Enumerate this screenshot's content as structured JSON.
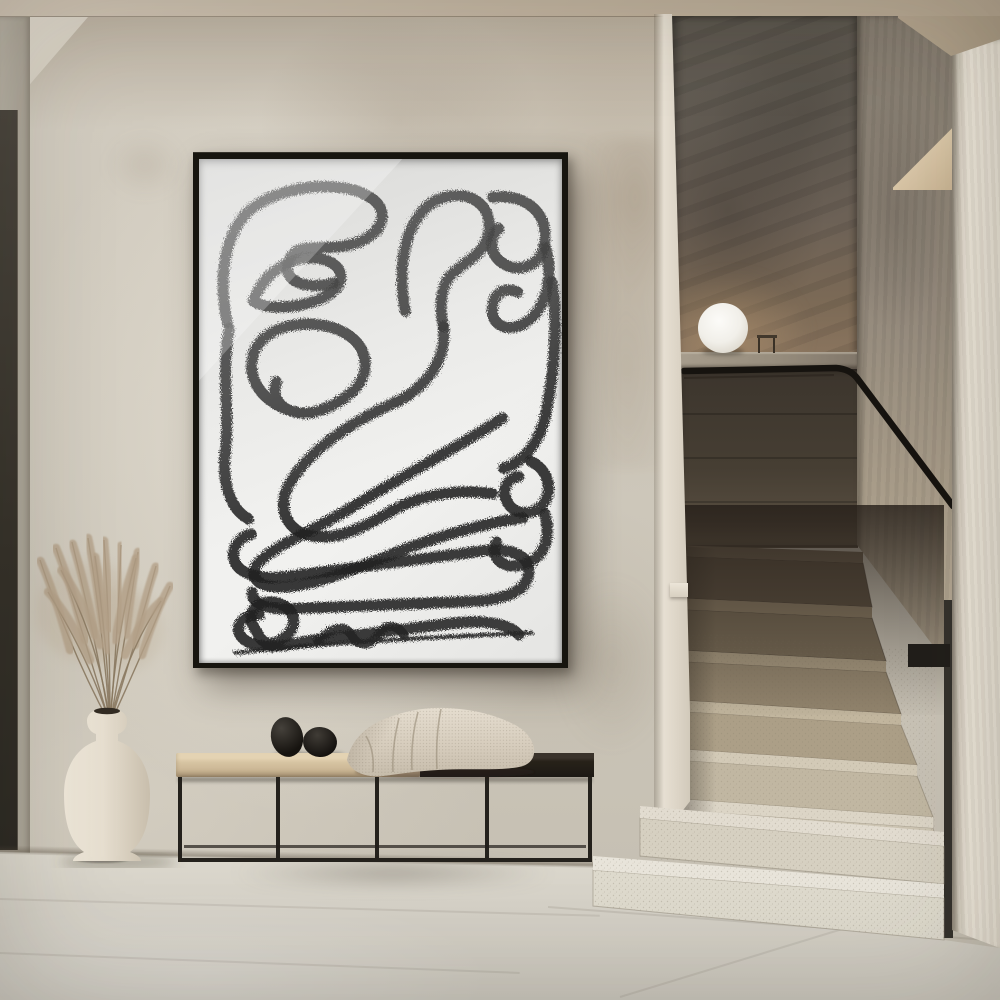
{
  "scene": {
    "description": "Minimalist interior hallway: black-framed abstract charcoal line-art poster on a greige plaster wall, wood-and-metal bench with two black stones and a knitted beige throw, white ceramic vase with dried pampas grass, and a terrazzo staircase with a black handrail and a white sphere lamp on the landing",
    "objects": [
      "abstract-line-art-poster",
      "plaster-wall",
      "sphere-lamp",
      "black-handrail",
      "terrazzo-staircase",
      "newel-post",
      "bench",
      "black-stones",
      "throw-blanket",
      "ceramic-vase",
      "pampas-grass",
      "stone-tile-floor",
      "dark-door-edge",
      "ceiling",
      "stair-side-wall"
    ]
  },
  "palette": {
    "wall": "#cfc9bc",
    "wall_shadow": "#a89a88",
    "ceiling": "#c2b4a0",
    "floor": "#d4d0c6",
    "frame": "#17150f",
    "paper": "#f1f1ef",
    "ink": "#222222",
    "stair_light": "#e8e4da",
    "stair_dark": "#5a4e40",
    "handrail": "#16130f",
    "bench_wood": "#d6c3a1",
    "bench_dark": "#272219",
    "blanket": "#d6ccbc",
    "vase": "#e9e1d2",
    "grass": "#b3a088",
    "lamp": "#f7f5f0"
  },
  "poster": {
    "stroke_width": 11,
    "art_paths": [
      {
        "d": "M28,162 C18,114 26,64 60,44 C94,24 146,22 170,38 C190,50 184,72 160,82 C128,95 97,78 89,102 C82,123 109,130 134,123"
      },
      {
        "d": "M54,141 C66,107 102,91 128,101 C149,110 144,130 118,140 C97,148 67,150 54,141"
      },
      {
        "d": "M205,151 C195,95 210,48 244,38 C274,30 293,50 288,74 C283,97 262,102 250,116 C240,128 239,147 243,166"
      },
      {
        "d": "M243,166 C247,199 226,228 192,243 C152,261 110,288 90,322 C77,345 86,369 112,374 C140,379 166,364 192,349 C220,333 258,327 292,332"
      },
      {
        "d": "M292,38 C322,34 347,51 344,81 C342,107 318,113 303,104 C289,96 288,79 298,69"
      },
      {
        "d": "M345,88 C353,121 344,152 322,164 C303,173 289,162 292,146 C294,131 307,127 317,132"
      },
      {
        "d": "M351,122 C357,163 353,213 345,252 C339,282 322,301 303,307"
      },
      {
        "d": "M96,251 C62,243 44,215 56,189 C70,161 118,157 146,173 C170,187 172,215 150,233 C131,248 111,255 95,251 C79,247 72,235 77,221"
      },
      {
        "d": "M30,168 C22,211 31,253 26,292 C23,322 31,347 49,357"
      },
      {
        "d": "M302,257 C262,283 196,318 148,348 C118,366 84,380 65,395 C49,407 52,422 72,424 C105,428 152,408 197,390 C243,372 292,360 322,356"
      },
      {
        "d": "M330,300 C348,308 353,330 341,344 C330,355 313,352 307,341 C300,329 306,317 318,315"
      },
      {
        "d": "M344,352 C351,378 342,398 320,403 C300,407 289,394 296,380"
      },
      {
        "d": "M52,372 C36,376 28,394 40,406 C51,416 73,417 97,413 L280,389 C310,385 330,393 328,411 C326,431 299,438 268,439 L97,446 C70,448 52,442 53,430"
      },
      {
        "d": "M60,452 C42,452 33,466 44,476 C56,487 84,484 108,478 L250,461 C280,457 308,460 318,472"
      },
      {
        "d": "M118,478 C134,463 146,462 152,473 C158,484 170,484 178,472 C186,461 196,461 204,472",
        "w": 9
      },
      {
        "d": "M36,490 C120,480 260,473 331,470",
        "w": 4
      },
      {
        "d": "M58,470 C44,452 56,436 76,440 C96,444 100,462 86,474 C74,484 62,482 58,470"
      }
    ]
  },
  "grass": {
    "origin": [
      110,
      724
    ],
    "stems": [
      {
        "b": [
          70,
          650
        ],
        "t": [
          40,
          560
        ]
      },
      {
        "b": [
          85,
          640
        ],
        "t": [
          56,
          548
        ]
      },
      {
        "b": [
          95,
          635
        ],
        "t": [
          72,
          542
        ]
      },
      {
        "b": [
          103,
          630
        ],
        "t": [
          88,
          538
        ]
      },
      {
        "b": [
          110,
          628
        ],
        "t": [
          104,
          540
        ]
      },
      {
        "b": [
          118,
          630
        ],
        "t": [
          121,
          545
        ]
      },
      {
        "b": [
          126,
          635
        ],
        "t": [
          138,
          552
        ]
      },
      {
        "b": [
          135,
          645
        ],
        "t": [
          156,
          566
        ]
      },
      {
        "b": [
          142,
          655
        ],
        "t": [
          170,
          586
        ]
      },
      {
        "b": [
          90,
          660
        ],
        "t": [
          48,
          592
        ]
      },
      {
        "b": [
          125,
          655
        ],
        "t": [
          161,
          601
        ]
      },
      {
        "b": [
          100,
          645
        ],
        "t": [
          61,
          570
        ]
      },
      {
        "b": [
          115,
          640
        ],
        "t": [
          136,
          558
        ]
      },
      {
        "b": [
          108,
          650
        ],
        "t": [
          95,
          556
        ]
      }
    ]
  },
  "stairs": {
    "steps_upper": [
      {
        "r": "674,556 863,563 872,607 674,598",
        "rf": "#5a4e40",
        "rs": "rgba(52,44,35,0.5)",
        "t": "674,545 863,552 863,563 674,556",
        "tf": "#6e6150"
      },
      {
        "r": "674,609 872,618 886,661 674,650",
        "rf": "#776a56",
        "rs": "rgba(52,44,35,0.5)",
        "t": "674,598 872,607 872,618 674,609",
        "tf": "#8c7d66"
      },
      {
        "r": "674,661 886,672 901,714 676,700",
        "rf": "#93856e",
        "rs": "rgba(80,70,56,0.5)",
        "t": "674,650 886,661 886,672 674,661",
        "tf": "#a89a81"
      },
      {
        "r": "676,711 901,725 917,765 678,749",
        "rf": "#ac9f87",
        "rs": "rgba(110,100,84,0.45)",
        "t": "676,700 901,714 901,725 676,711",
        "tf": "#c2b69e"
      },
      {
        "r": "678,760 917,776 933,817 680,799",
        "rf": "#c1b7a2",
        "rs": "rgba(120,110,94,0.45)",
        "t": "678,749 917,765 917,776 678,760",
        "tf": "#d3cab7"
      },
      {
        "r": "680,810 933,828 944,870 682,852",
        "rf": "#cdc5b3",
        "rs": "rgba(130,122,106,0.45)",
        "t": "680,799 933,817 933,828 680,810",
        "tf": "#dcd5c6"
      }
    ],
    "steps_lower": [
      {
        "r": "640,818 944,846 944,884 640,856",
        "rf": "#d6d0c1",
        "rs": "rgba(140,132,116,0.5)",
        "t": "640,806 944,832 944,846 640,818",
        "tf": "#e2dcd0"
      },
      {
        "r": "593,870 944,898 944,940 593,906",
        "rf": "#dedacd",
        "rs": "rgba(140,132,116,0.5)",
        "t": "593,856 944,884 944,898 593,870",
        "tf": "#e8e4da"
      }
    ]
  },
  "handrail": {
    "rail_path": "M684,371 L836,368 Q850,369 857,378 L953,506",
    "rail_shadow": "M684,378 L834,375",
    "post": {
      "x": 944,
      "y": 600,
      "w": 9,
      "h": 338
    },
    "bracket": {
      "x": 908,
      "y": 644,
      "w": 42,
      "h": 23
    }
  },
  "lamp": {
    "cx": 723,
    "cy": 328,
    "r": 25
  }
}
